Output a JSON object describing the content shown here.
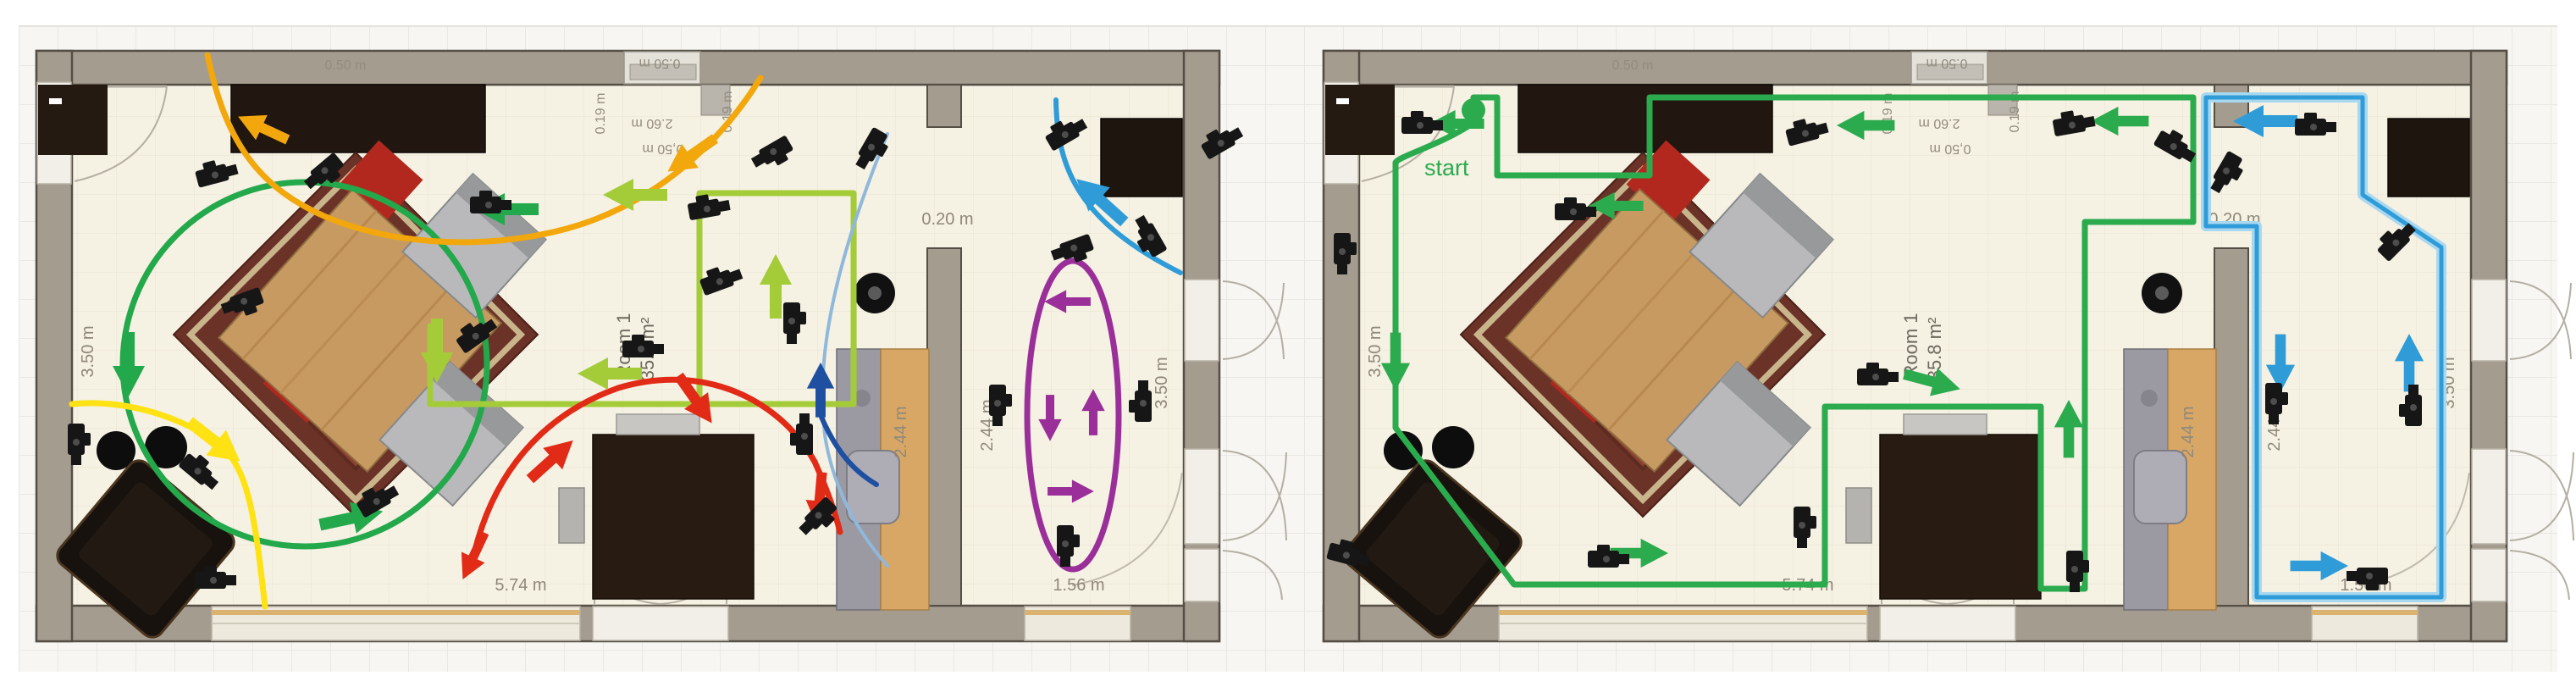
{
  "labels": {
    "room_name": "Room 1",
    "room_area": "35.8 m²",
    "dim_left_wall": "3.50 m",
    "dim_bottom_main": "5.74 m",
    "dim_passage": "0.20 m",
    "dim_counter": "2.44 m",
    "dim_room2_left": "2.44 m",
    "dim_room2_right": "3.50 m",
    "dim_room2_bottom": "1.56 m",
    "dim_shelf_depth": "0.50 m",
    "dim_window_left": "0.19 m",
    "dim_window_right": "0.19 m",
    "dim_window_width": "0,50 m",
    "dim_window_above": "0.50 m",
    "dim_window_alt": "2.60 m",
    "start_label": "start"
  },
  "icons": {
    "camera": "camera-icon",
    "start_marker": "start-dot-icon",
    "arrow": "direction-arrow-icon"
  },
  "colors": {
    "trajectory_green": "#23A84B",
    "trajectory_lightgreen": "#A4CC39",
    "trajectory_yellow": "#FFE213",
    "trajectory_orange": "#F2A70C",
    "trajectory_red": "#E12B17",
    "trajectory_blue": "#2F9CD8",
    "trajectory_darkblue": "#1E4FA0",
    "trajectory_lightblue": "#8FB8DC",
    "trajectory_purple": "#9A2F9A",
    "wall_fill": "#A59C90",
    "floor_fill": "#F5F1E3",
    "dimension_text": "#8F887A",
    "start_green": "#2BAB4D"
  }
}
